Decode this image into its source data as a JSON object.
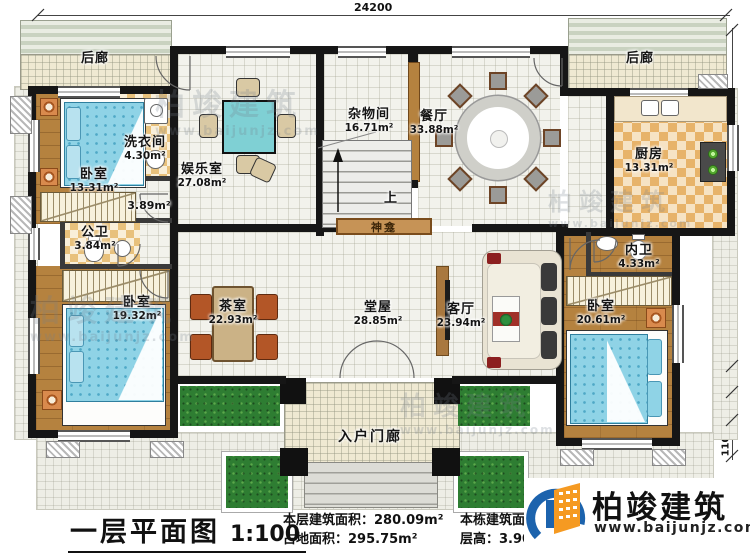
{
  "title_block": {
    "title": "一层平面图",
    "scale": "1:100",
    "stats": [
      {
        "label": "本层建筑面积：",
        "value": "280.09m²"
      },
      {
        "label": "占地面积：",
        "value": "295.75m²"
      },
      {
        "label": "本栋建筑面积：",
        "value": "825.36m²"
      },
      {
        "label": "层高：",
        "value": "3.90m"
      }
    ]
  },
  "brand": {
    "name": "柏竣建筑",
    "website": "www.baijunjz.com"
  },
  "dimensions": {
    "top_width": "24200",
    "right_total": "11400",
    "seg_600": "600",
    "seg_900": "900",
    "seg_1100": "1100"
  },
  "rooms": {
    "porch_back_left": {
      "name": "后廊"
    },
    "porch_back_right": {
      "name": "后廊"
    },
    "laundry": {
      "name": "洗衣间",
      "area": "4.30m²"
    },
    "bedroom_top_left": {
      "name": "卧室",
      "area": "13.31m²"
    },
    "entertainment": {
      "name": "娱乐室",
      "area": "27.08m²"
    },
    "storage": {
      "name": "杂物间",
      "area": "16.71m²"
    },
    "dining": {
      "name": "餐厅",
      "area": "33.88m²"
    },
    "kitchen": {
      "name": "厨房",
      "area": "13.31m²"
    },
    "corridor": {
      "area": "3.89m²"
    },
    "public_bath": {
      "name": "公卫",
      "area": "3.84m²"
    },
    "private_bath": {
      "name": "内卫",
      "area": "4.33m²"
    },
    "bedroom_bottom_left": {
      "name": "卧室",
      "area": "19.32m²"
    },
    "tea_room": {
      "name": "茶室",
      "area": "22.93m²"
    },
    "main_hall": {
      "name": "堂屋",
      "area": "28.85m²"
    },
    "living_room": {
      "name": "客厅",
      "area": "23.94m²"
    },
    "bedroom_bottom_right": {
      "name": "卧室",
      "area": "20.61m²"
    },
    "shrine": {
      "name": "神龛"
    },
    "stairs": {
      "direction_label": "上"
    },
    "entry_porch": {
      "name": "入户门廊"
    }
  }
}
